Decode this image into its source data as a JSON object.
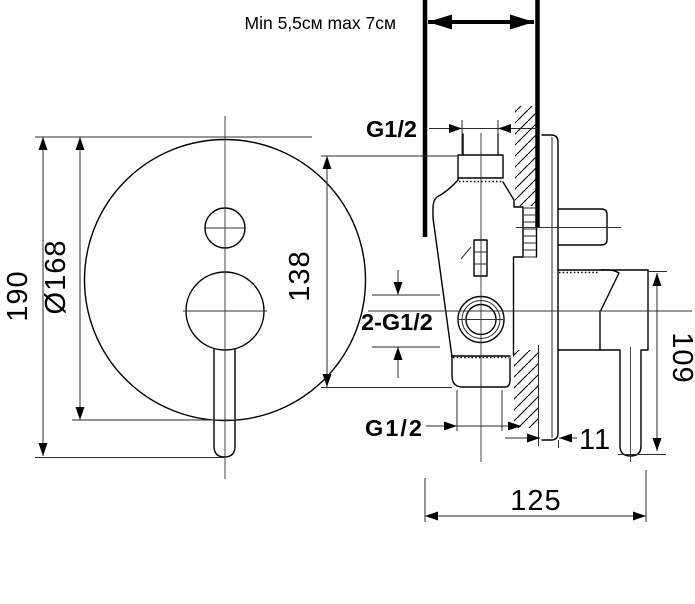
{
  "drawing": {
    "depth_note": "Min 5,5см max 7см",
    "labels": {
      "top_thread": "G1/2",
      "side_threads": "2-G1/2",
      "bottom_thread": "G1/2"
    },
    "dims": {
      "overall_height": "190",
      "plate_diameter": "Ø168",
      "center_height": "138",
      "handle_depth": "109",
      "total_depth": "125",
      "plate_offset": "11"
    },
    "colors": {
      "line": "#000000",
      "dim": "#2b2b2b",
      "bg": "#ffffff"
    }
  }
}
